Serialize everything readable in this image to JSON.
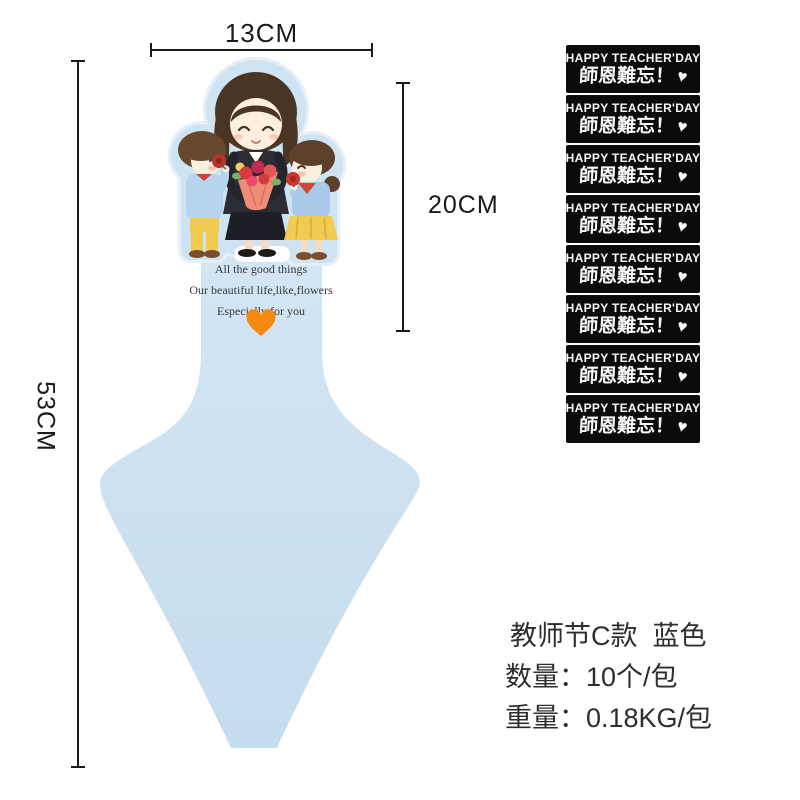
{
  "dimensions": {
    "width_label": "13CM",
    "handle_height_label": "20CM",
    "total_height_label": "53CM"
  },
  "product": {
    "message_lines": [
      "All the good things",
      "Our beautiful life,like,flowers",
      "Especially for you"
    ],
    "heart_icon": "orange-heart",
    "colors": {
      "body_blue": "#cde2f1",
      "backing_blue": "#cfe4f3",
      "heart_orange": "#f5880f"
    }
  },
  "stickers": {
    "count": 8,
    "text_en": "HAPPY TEACHER'DAY",
    "text_cn": "師恩難忘！",
    "heart_icon": "white-heart",
    "background": "#0b0b0b"
  },
  "specs": {
    "title": "教师节C款  蓝色",
    "quantity": "数量：10个/包",
    "weight": "重量：0.18KG/包"
  }
}
